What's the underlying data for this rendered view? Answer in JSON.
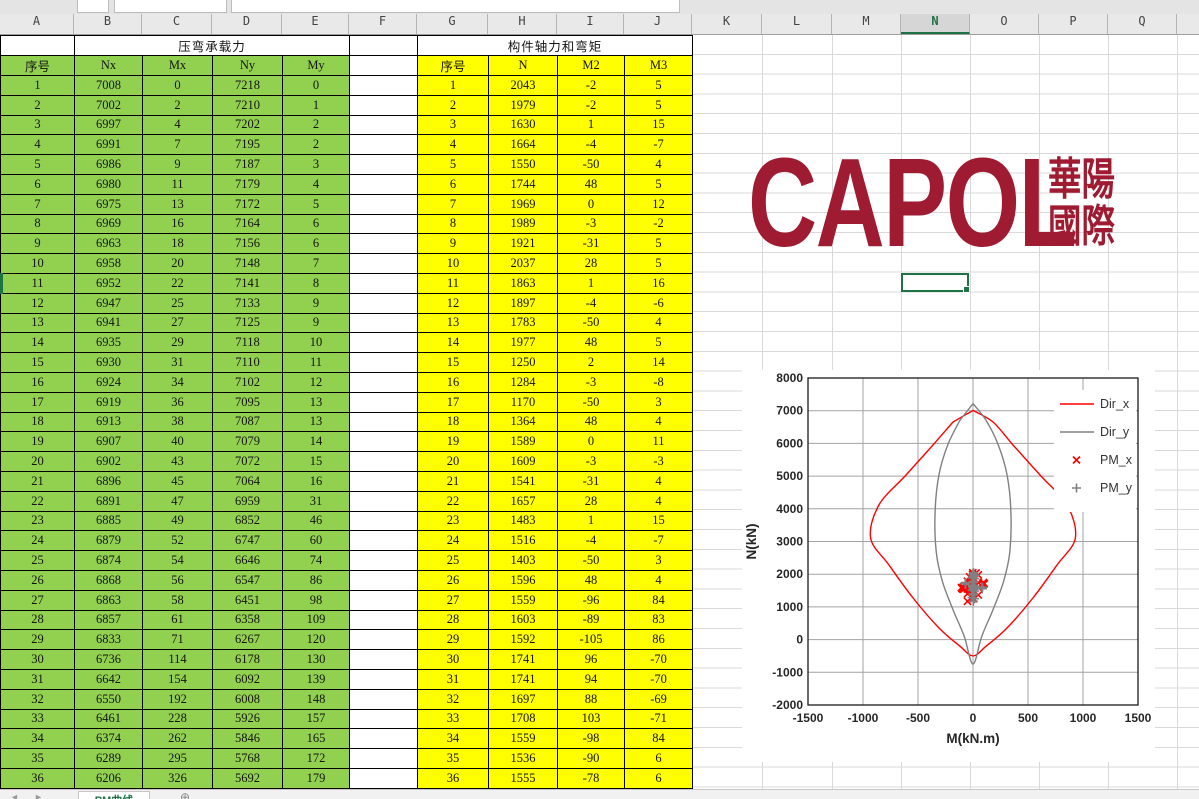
{
  "columns": [
    "A",
    "B",
    "C",
    "D",
    "E",
    "F",
    "G",
    "H",
    "I",
    "J",
    "K",
    "L",
    "M",
    "N",
    "O",
    "P",
    "Q"
  ],
  "column_widths": [
    74,
    68,
    70,
    70,
    67,
    68,
    71,
    69,
    67,
    68,
    70,
    70,
    69,
    69,
    69,
    69,
    69
  ],
  "selected_column": "N",
  "selected_cell": "N11",
  "sheet_tab": {
    "label": "PM曲线",
    "add_label": "+"
  },
  "green_table": {
    "title": "压弯承载力",
    "headers": [
      "序号",
      "Nx",
      "Mx",
      "Ny",
      "My"
    ],
    "rows": [
      [
        1,
        7008,
        0,
        7218,
        0
      ],
      [
        2,
        7002,
        2,
        7210,
        1
      ],
      [
        3,
        6997,
        4,
        7202,
        2
      ],
      [
        4,
        6991,
        7,
        7195,
        2
      ],
      [
        5,
        6986,
        9,
        7187,
        3
      ],
      [
        6,
        6980,
        11,
        7179,
        4
      ],
      [
        7,
        6975,
        13,
        7172,
        5
      ],
      [
        8,
        6969,
        16,
        7164,
        6
      ],
      [
        9,
        6963,
        18,
        7156,
        6
      ],
      [
        10,
        6958,
        20,
        7148,
        7
      ],
      [
        11,
        6952,
        22,
        7141,
        8
      ],
      [
        12,
        6947,
        25,
        7133,
        9
      ],
      [
        13,
        6941,
        27,
        7125,
        9
      ],
      [
        14,
        6935,
        29,
        7118,
        10
      ],
      [
        15,
        6930,
        31,
        7110,
        11
      ],
      [
        16,
        6924,
        34,
        7102,
        12
      ],
      [
        17,
        6919,
        36,
        7095,
        13
      ],
      [
        18,
        6913,
        38,
        7087,
        13
      ],
      [
        19,
        6907,
        40,
        7079,
        14
      ],
      [
        20,
        6902,
        43,
        7072,
        15
      ],
      [
        21,
        6896,
        45,
        7064,
        16
      ],
      [
        22,
        6891,
        47,
        6959,
        31
      ],
      [
        23,
        6885,
        49,
        6852,
        46
      ],
      [
        24,
        6879,
        52,
        6747,
        60
      ],
      [
        25,
        6874,
        54,
        6646,
        74
      ],
      [
        26,
        6868,
        56,
        6547,
        86
      ],
      [
        27,
        6863,
        58,
        6451,
        98
      ],
      [
        28,
        6857,
        61,
        6358,
        109
      ],
      [
        29,
        6833,
        71,
        6267,
        120
      ],
      [
        30,
        6736,
        114,
        6178,
        130
      ],
      [
        31,
        6642,
        154,
        6092,
        139
      ],
      [
        32,
        6550,
        192,
        6008,
        148
      ],
      [
        33,
        6461,
        228,
        5926,
        157
      ],
      [
        34,
        6374,
        262,
        5846,
        165
      ],
      [
        35,
        6289,
        295,
        5768,
        172
      ],
      [
        36,
        6206,
        326,
        5692,
        179
      ]
    ]
  },
  "yellow_table": {
    "title": "构件轴力和弯矩",
    "headers": [
      "序号",
      "N",
      "M2",
      "M3"
    ],
    "rows": [
      [
        1,
        2043,
        -2,
        5
      ],
      [
        2,
        1979,
        -2,
        5
      ],
      [
        3,
        1630,
        1,
        15
      ],
      [
        4,
        1664,
        -4,
        -7
      ],
      [
        5,
        1550,
        -50,
        4
      ],
      [
        6,
        1744,
        48,
        5
      ],
      [
        7,
        1969,
        0,
        12
      ],
      [
        8,
        1989,
        -3,
        -2
      ],
      [
        9,
        1921,
        -31,
        5
      ],
      [
        10,
        2037,
        28,
        5
      ],
      [
        11,
        1863,
        1,
        16
      ],
      [
        12,
        1897,
        -4,
        -6
      ],
      [
        13,
        1783,
        -50,
        4
      ],
      [
        14,
        1977,
        48,
        5
      ],
      [
        15,
        1250,
        2,
        14
      ],
      [
        16,
        1284,
        -3,
        -8
      ],
      [
        17,
        1170,
        -50,
        3
      ],
      [
        18,
        1364,
        48,
        4
      ],
      [
        19,
        1589,
        0,
        11
      ],
      [
        20,
        1609,
        -3,
        -3
      ],
      [
        21,
        1541,
        -31,
        4
      ],
      [
        22,
        1657,
        28,
        4
      ],
      [
        23,
        1483,
        1,
        15
      ],
      [
        24,
        1516,
        -4,
        -7
      ],
      [
        25,
        1403,
        -50,
        3
      ],
      [
        26,
        1596,
        48,
        4
      ],
      [
        27,
        1559,
        -96,
        84
      ],
      [
        28,
        1603,
        -89,
        83
      ],
      [
        29,
        1592,
        -105,
        86
      ],
      [
        30,
        1741,
        96,
        -70
      ],
      [
        31,
        1741,
        94,
        -70
      ],
      [
        32,
        1697,
        88,
        -69
      ],
      [
        33,
        1708,
        103,
        -71
      ],
      [
        34,
        1559,
        -98,
        84
      ],
      [
        35,
        1536,
        -90,
        6
      ],
      [
        36,
        1555,
        -78,
        6
      ]
    ]
  },
  "logo": {
    "text": "CAPOL",
    "cjk_line1": "華陽",
    "cjk_line2": "國際",
    "color": "#9e1b32"
  },
  "chart_data": {
    "type": "line",
    "title": "",
    "xlabel": "M(kN.m)",
    "ylabel": "N(kN)",
    "xlim": [
      -1500,
      1500
    ],
    "xticks": [
      -1500,
      -1000,
      -500,
      0,
      500,
      1000,
      1500
    ],
    "ylim": [
      -2000,
      8000
    ],
    "yticks": [
      8000,
      7000,
      6000,
      5000,
      4000,
      3000,
      2000,
      1000,
      0,
      -1000,
      -2000
    ],
    "grid": true,
    "legend_position": "inside-top-right",
    "series": [
      {
        "name": "Dir_x",
        "type": "line",
        "color": "#ff0000",
        "half_points": [
          [
            0,
            7008
          ],
          [
            182,
            6654
          ],
          [
            364,
            5951
          ],
          [
            609,
            5034
          ],
          [
            855,
            4116
          ],
          [
            930,
            3100
          ],
          [
            764,
            2281
          ],
          [
            545,
            1272
          ],
          [
            309,
            355
          ],
          [
            120,
            -200
          ],
          [
            0,
            -500
          ]
        ]
      },
      {
        "name": "Dir_y",
        "type": "line",
        "color": "#808080",
        "half_points": [
          [
            0,
            7218
          ],
          [
            120,
            6700
          ],
          [
            230,
            5950
          ],
          [
            310,
            5030
          ],
          [
            345,
            3900
          ],
          [
            335,
            2700
          ],
          [
            280,
            1800
          ],
          [
            180,
            900
          ],
          [
            80,
            100
          ],
          [
            0,
            -750
          ]
        ]
      },
      {
        "name": "PM_x",
        "type": "scatter",
        "marker": "x",
        "color": "#ff0000",
        "points": [
          [
            -2,
            2043
          ],
          [
            -2,
            1979
          ],
          [
            1,
            1630
          ],
          [
            -4,
            1664
          ],
          [
            -50,
            1550
          ],
          [
            48,
            1744
          ],
          [
            0,
            1969
          ],
          [
            -3,
            1989
          ],
          [
            -31,
            1921
          ],
          [
            28,
            2037
          ],
          [
            1,
            1863
          ],
          [
            -4,
            1897
          ],
          [
            -50,
            1783
          ],
          [
            48,
            1977
          ],
          [
            2,
            1250
          ],
          [
            -3,
            1284
          ],
          [
            -50,
            1170
          ],
          [
            48,
            1364
          ],
          [
            0,
            1589
          ],
          [
            -3,
            1609
          ],
          [
            -31,
            1541
          ],
          [
            28,
            1657
          ],
          [
            1,
            1483
          ],
          [
            -4,
            1516
          ],
          [
            -50,
            1403
          ],
          [
            48,
            1596
          ],
          [
            -96,
            1559
          ],
          [
            -89,
            1603
          ],
          [
            -105,
            1592
          ],
          [
            96,
            1741
          ],
          [
            94,
            1741
          ],
          [
            88,
            1697
          ],
          [
            103,
            1708
          ],
          [
            -98,
            1559
          ],
          [
            -90,
            1536
          ],
          [
            -78,
            1555
          ]
        ]
      },
      {
        "name": "PM_y",
        "type": "scatter",
        "marker": "+",
        "color": "#808080",
        "points": [
          [
            5,
            2043
          ],
          [
            5,
            1979
          ],
          [
            15,
            1630
          ],
          [
            -7,
            1664
          ],
          [
            4,
            1550
          ],
          [
            5,
            1744
          ],
          [
            12,
            1969
          ],
          [
            -2,
            1989
          ],
          [
            5,
            1921
          ],
          [
            5,
            2037
          ],
          [
            16,
            1863
          ],
          [
            -6,
            1897
          ],
          [
            4,
            1783
          ],
          [
            5,
            1977
          ],
          [
            14,
            1250
          ],
          [
            -8,
            1284
          ],
          [
            3,
            1170
          ],
          [
            4,
            1364
          ],
          [
            11,
            1589
          ],
          [
            -3,
            1609
          ],
          [
            4,
            1541
          ],
          [
            4,
            1657
          ],
          [
            15,
            1483
          ],
          [
            -7,
            1516
          ],
          [
            3,
            1403
          ],
          [
            4,
            1596
          ],
          [
            84,
            1559
          ],
          [
            83,
            1603
          ],
          [
            86,
            1592
          ],
          [
            -70,
            1741
          ],
          [
            -70,
            1741
          ],
          [
            -69,
            1697
          ],
          [
            -71,
            1708
          ],
          [
            84,
            1559
          ],
          [
            6,
            1536
          ],
          [
            6,
            1555
          ]
        ]
      }
    ]
  }
}
